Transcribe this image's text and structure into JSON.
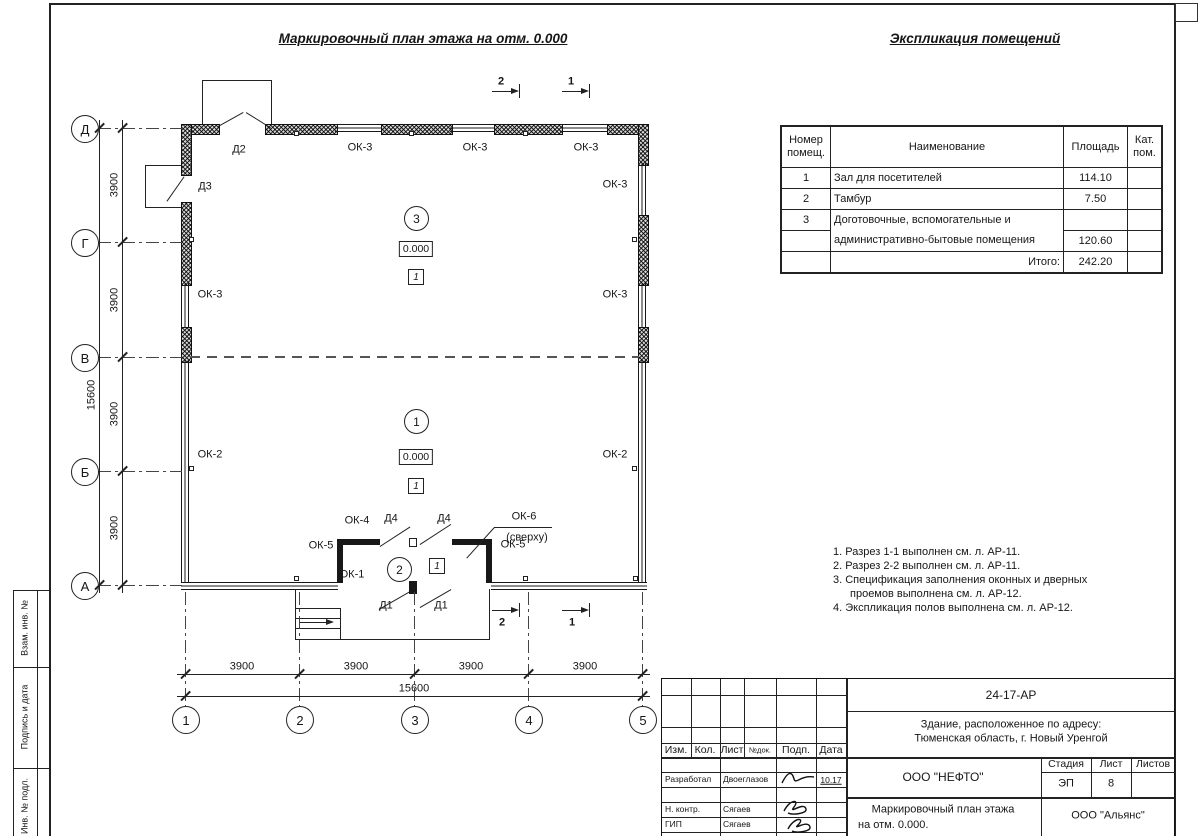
{
  "page": {
    "plan_title": "Маркировочный план этажа на отм. 0.000",
    "table_title": "Экспликация помещений"
  },
  "plan": {
    "axis_letters": [
      "Д",
      "Г",
      "В",
      "Б",
      "А"
    ],
    "axis_numbers": [
      "1",
      "2",
      "3",
      "4",
      "5"
    ],
    "dim_segment": "3900",
    "dim_total": "15600",
    "sections": {
      "s1": "1",
      "s2": "2"
    },
    "labels": {
      "ok1": "ОК-1",
      "ok2": "ОК-2",
      "ok3": "ОК-3",
      "ok4": "ОК-4",
      "ok5": "ОК-5",
      "ok6": "ОК-6",
      "ok6_note": "(сверху)",
      "d1": "Д1",
      "d2": "Д2",
      "d3": "Д3",
      "d4": "Д4"
    },
    "rooms": {
      "r1": {
        "num": "1",
        "elev": "0.000",
        "floor": "1"
      },
      "r2": {
        "num": "2",
        "floor": "1"
      },
      "r3": {
        "num": "3",
        "elev": "0.000",
        "floor": "1"
      }
    }
  },
  "room_table": {
    "headers": {
      "num": "Номер помещ.",
      "name": "Наименование",
      "area": "Площадь",
      "cat": "Кат. пом."
    },
    "rows": [
      {
        "num": "1",
        "name": "Зал для посетителей",
        "area": "114.10",
        "cat": ""
      },
      {
        "num": "2",
        "name": "Тамбур",
        "area": "7.50",
        "cat": ""
      },
      {
        "num": "3",
        "name": "Доготовочные, вспомогательные и",
        "area": "",
        "cat": ""
      },
      {
        "num": "",
        "name": "административно-бытовые помещения",
        "area": "120.60",
        "cat": ""
      },
      {
        "num": "",
        "name": "Итого:",
        "area": "242.20",
        "cat": ""
      }
    ]
  },
  "notes": {
    "lines": [
      "1. Разрез 1-1 выполнен см. л. АР-11.",
      "2. Разрез 2-2 выполнен см. л. АР-11.",
      "3. Спецификация заполнения оконных и дверных",
      "проемов выполнена см. л. АР-12.",
      "4. Экспликация полов выполнена см. л. АР-12."
    ]
  },
  "title_block": {
    "doc_number": "24-17-АР",
    "object_line1": "Здание, расположенное по адресу:",
    "object_line2": "Тюменская область, г. Новый Уренгой",
    "col_izm": "Изм.",
    "col_kol": "Кол.",
    "col_list": "Лист",
    "col_ndoc": "№док.",
    "col_podp": "Подп.",
    "col_data": "Дата",
    "row1_role": "Разработал",
    "row1_name": "Двоеглазов",
    "row1_date": "10.17",
    "row2_role": "Н. контр.",
    "row2_name": "Сягаев",
    "row3_role": "ГИП",
    "row3_name": "Сягаев",
    "company": "ООО \"НЕФТО\"",
    "stage_label": "Стадия",
    "list_label": "Лист",
    "listov_label": "Листов",
    "stage": "ЭП",
    "list_num": "8",
    "listov": "",
    "title_line1": "Маркировочный план этажа",
    "title_line2": "на отм. 0.000.",
    "org": "ООО \"Альянс\""
  },
  "side_labels": {
    "l1": "Взам. инв. №",
    "l2": "Подпись и дата",
    "l3": "Инв. № подл."
  }
}
